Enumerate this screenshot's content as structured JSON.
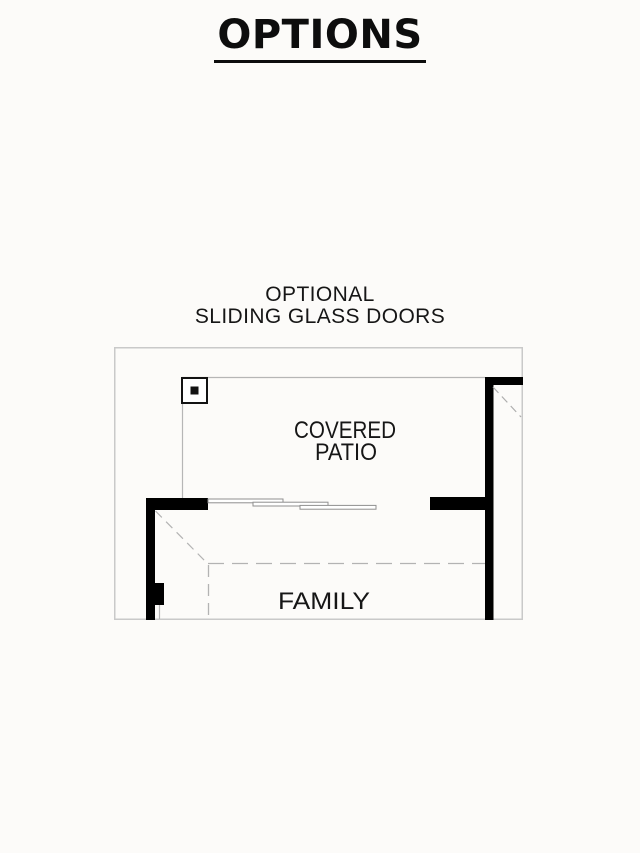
{
  "page": {
    "title": "OPTIONS",
    "background_color": "#fcfbf9"
  },
  "option_label": {
    "line1": "OPTIONAL",
    "line2": "SLIDING GLASS DOORS"
  },
  "floorplan": {
    "rooms": {
      "covered_patio_line1": "COVERED",
      "covered_patio_line2": "PATIO",
      "family": "FAMILY"
    },
    "symbols": {
      "post": "patio-post-column",
      "doors": "triple-sliding-glass-door-panels",
      "dashed": "ceiling-break-overhang-lines"
    },
    "colors": {
      "wall": "#000000",
      "thin_line": "#b6b6b6",
      "plan_border": "#c9c9c9",
      "dashed_line": "#b3b3b3",
      "door_outline": "#8f8f8f",
      "text": "#161616"
    }
  }
}
